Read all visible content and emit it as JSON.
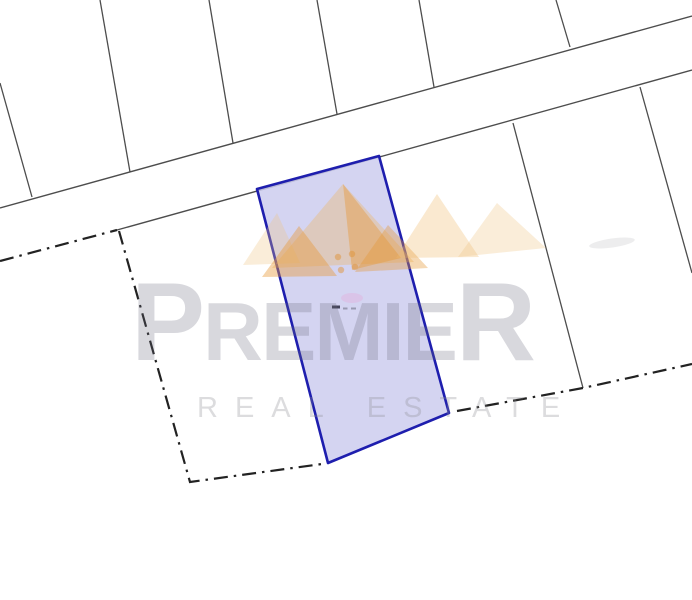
{
  "map": {
    "background": "#ffffff",
    "boundary_line_color": "#4d4d4d",
    "cadastral_line_color": "#222222",
    "parcel_fill": "rgba(205,205,238,0.85)",
    "parcel_stroke": "#1e1eae",
    "svg_layers": [
      {
        "name": "road-top-edge",
        "type": "line",
        "attrs": {
          "x1": 0,
          "y1": 208,
          "x2": 692,
          "y2": 16,
          "stroke": "#4d4d4d",
          "stroke-width": 1.4
        }
      },
      {
        "name": "road-bottom-edge",
        "type": "line",
        "attrs": {
          "x1": 117,
          "y1": 230,
          "x2": 692,
          "y2": 70,
          "stroke": "#4d4d4d",
          "stroke-width": 1.4
        }
      },
      {
        "name": "plot-boundary-line",
        "type": "line",
        "attrs": {
          "x1": 0,
          "y1": 83,
          "x2": 32,
          "y2": 197,
          "stroke": "#4d4d4d",
          "stroke-width": 1.3
        }
      },
      {
        "name": "plot-boundary-line",
        "type": "line",
        "attrs": {
          "x1": 100,
          "y1": 0,
          "x2": 130,
          "y2": 172,
          "stroke": "#4d4d4d",
          "stroke-width": 1.3
        }
      },
      {
        "name": "plot-boundary-line",
        "type": "line",
        "attrs": {
          "x1": 209,
          "y1": 0,
          "x2": 233,
          "y2": 143,
          "stroke": "#4d4d4d",
          "stroke-width": 1.3
        }
      },
      {
        "name": "plot-boundary-line",
        "type": "line",
        "attrs": {
          "x1": 317,
          "y1": 0,
          "x2": 337,
          "y2": 114,
          "stroke": "#4d4d4d",
          "stroke-width": 1.3
        }
      },
      {
        "name": "plot-boundary-line",
        "type": "line",
        "attrs": {
          "x1": 419,
          "y1": 0,
          "x2": 434,
          "y2": 87,
          "stroke": "#4d4d4d",
          "stroke-width": 1.3
        }
      },
      {
        "name": "plot-boundary-line",
        "type": "line",
        "attrs": {
          "x1": 556,
          "y1": 0,
          "x2": 570,
          "y2": 47,
          "stroke": "#4d4d4d",
          "stroke-width": 1.3
        }
      },
      {
        "name": "plot-boundary-line",
        "type": "line",
        "attrs": {
          "x1": 513,
          "y1": 123,
          "x2": 583,
          "y2": 388,
          "stroke": "#4d4d4d",
          "stroke-width": 1.3
        }
      },
      {
        "name": "plot-boundary-line",
        "type": "line",
        "attrs": {
          "x1": 640,
          "y1": 87,
          "x2": 692,
          "y2": 273,
          "stroke": "#4d4d4d",
          "stroke-width": 1.3
        }
      },
      {
        "name": "cadastral-dashdot-west",
        "type": "polyline",
        "attrs": {
          "points": "0,261 117,230",
          "stroke": "#222222",
          "stroke-width": 2.2,
          "fill": "none",
          "stroke-dasharray": "14 6 2.5 6"
        }
      },
      {
        "name": "cadastral-dashdot-southwest",
        "type": "polyline",
        "attrs": {
          "points": "119,231 190,482 322,464",
          "stroke": "#222222",
          "stroke-width": 2.2,
          "fill": "none",
          "stroke-dasharray": "14 6 2.5 6"
        }
      },
      {
        "name": "cadastral-dashdot-southeast",
        "type": "polyline",
        "attrs": {
          "points": "457,411 583,388 692,364",
          "stroke": "#222222",
          "stroke-width": 2.2,
          "fill": "none",
          "stroke-dasharray": "14 6 2.5 6"
        }
      },
      {
        "name": "highlighted-parcel",
        "type": "polygon",
        "attrs": {
          "points": "257,189 379,156 449,413 328,463",
          "fill": "rgba(205,205,238,0.85)",
          "stroke": "#1e1eae",
          "stroke-width": 2.6,
          "stroke-linejoin": "round"
        }
      },
      {
        "name": "logo-mountain-faint-left",
        "type": "polygon",
        "attrs": {
          "points": "277,213 243,265 300,263",
          "fill": "rgba(240,196,130,0.30)"
        }
      },
      {
        "name": "logo-mountain-main",
        "type": "polygon",
        "attrs": {
          "points": "343,184 272,268 414,262",
          "fill": "rgba(238,180,92,0.35)"
        }
      },
      {
        "name": "logo-mountain-accent-left",
        "type": "polygon",
        "attrs": {
          "points": "299,226 262,277 337,276",
          "fill": "rgba(230,152,56,0.42)"
        }
      },
      {
        "name": "logo-mountain-accent-mid",
        "type": "polygon",
        "attrs": {
          "points": "343,184 401,258 352,270",
          "fill": "rgba(230,152,56,0.42)"
        }
      },
      {
        "name": "logo-mountain-accent-right",
        "type": "polygon",
        "attrs": {
          "points": "388,225 355,272 428,268",
          "fill": "rgba(230,152,56,0.38)"
        }
      },
      {
        "name": "logo-mountain-second-peak",
        "type": "polygon",
        "attrs": {
          "points": "437,194 396,258 479,257",
          "fill": "rgba(238,186,108,0.32)"
        }
      },
      {
        "name": "logo-mountain-faint-right",
        "type": "polygon",
        "attrs": {
          "points": "497,203 458,257 546,248",
          "fill": "rgba(240,196,130,0.30)"
        }
      },
      {
        "name": "logo-dot",
        "type": "circle",
        "attrs": {
          "cx": 338,
          "cy": 257,
          "r": 3.2,
          "fill": "rgba(224,148,58,0.50)"
        }
      },
      {
        "name": "logo-dot",
        "type": "circle",
        "attrs": {
          "cx": 352,
          "cy": 254,
          "r": 3.2,
          "fill": "rgba(224,148,58,0.50)"
        }
      },
      {
        "name": "logo-dot",
        "type": "circle",
        "attrs": {
          "cx": 341,
          "cy": 270,
          "r": 3.2,
          "fill": "rgba(224,148,58,0.50)"
        }
      },
      {
        "name": "logo-dot",
        "type": "circle",
        "attrs": {
          "cx": 355,
          "cy": 267,
          "r": 3.2,
          "fill": "rgba(224,148,58,0.50)"
        }
      },
      {
        "name": "pink-smudge",
        "type": "ellipse",
        "attrs": {
          "cx": 352,
          "cy": 298,
          "rx": 11,
          "ry": 5,
          "fill": "rgba(233,160,213,0.30)"
        }
      },
      {
        "name": "parcel-label-mark",
        "type": "rect",
        "attrs": {
          "x": 332,
          "y": 305.5,
          "width": 8,
          "height": 3,
          "fill": "#44445a"
        }
      },
      {
        "name": "parcel-label-mark",
        "type": "rect",
        "attrs": {
          "x": 343,
          "y": 307.5,
          "width": 4.5,
          "height": 2,
          "fill": "#9a9ab2"
        }
      },
      {
        "name": "parcel-label-mark",
        "type": "rect",
        "attrs": {
          "x": 351,
          "y": 307.5,
          "width": 5,
          "height": 2,
          "fill": "#9a9ab2"
        }
      },
      {
        "name": "faint-streak",
        "type": "ellipse",
        "attrs": {
          "cx": 612,
          "cy": 243,
          "rx": 23,
          "ry": 4.5,
          "fill": "rgba(195,195,198,0.30)",
          "transform": "rotate(-8 612 243)"
        }
      }
    ]
  },
  "watermark": {
    "brand": "PREMIER",
    "brand_first": "P",
    "brand_middle": "REMIE",
    "brand_last": "R",
    "subtitle": "REAL ESTATE",
    "brand_color": "rgba(105,105,125,0.26)",
    "subtitle_color": "rgba(140,140,145,0.30)",
    "logo_gold": "#eab45c"
  }
}
